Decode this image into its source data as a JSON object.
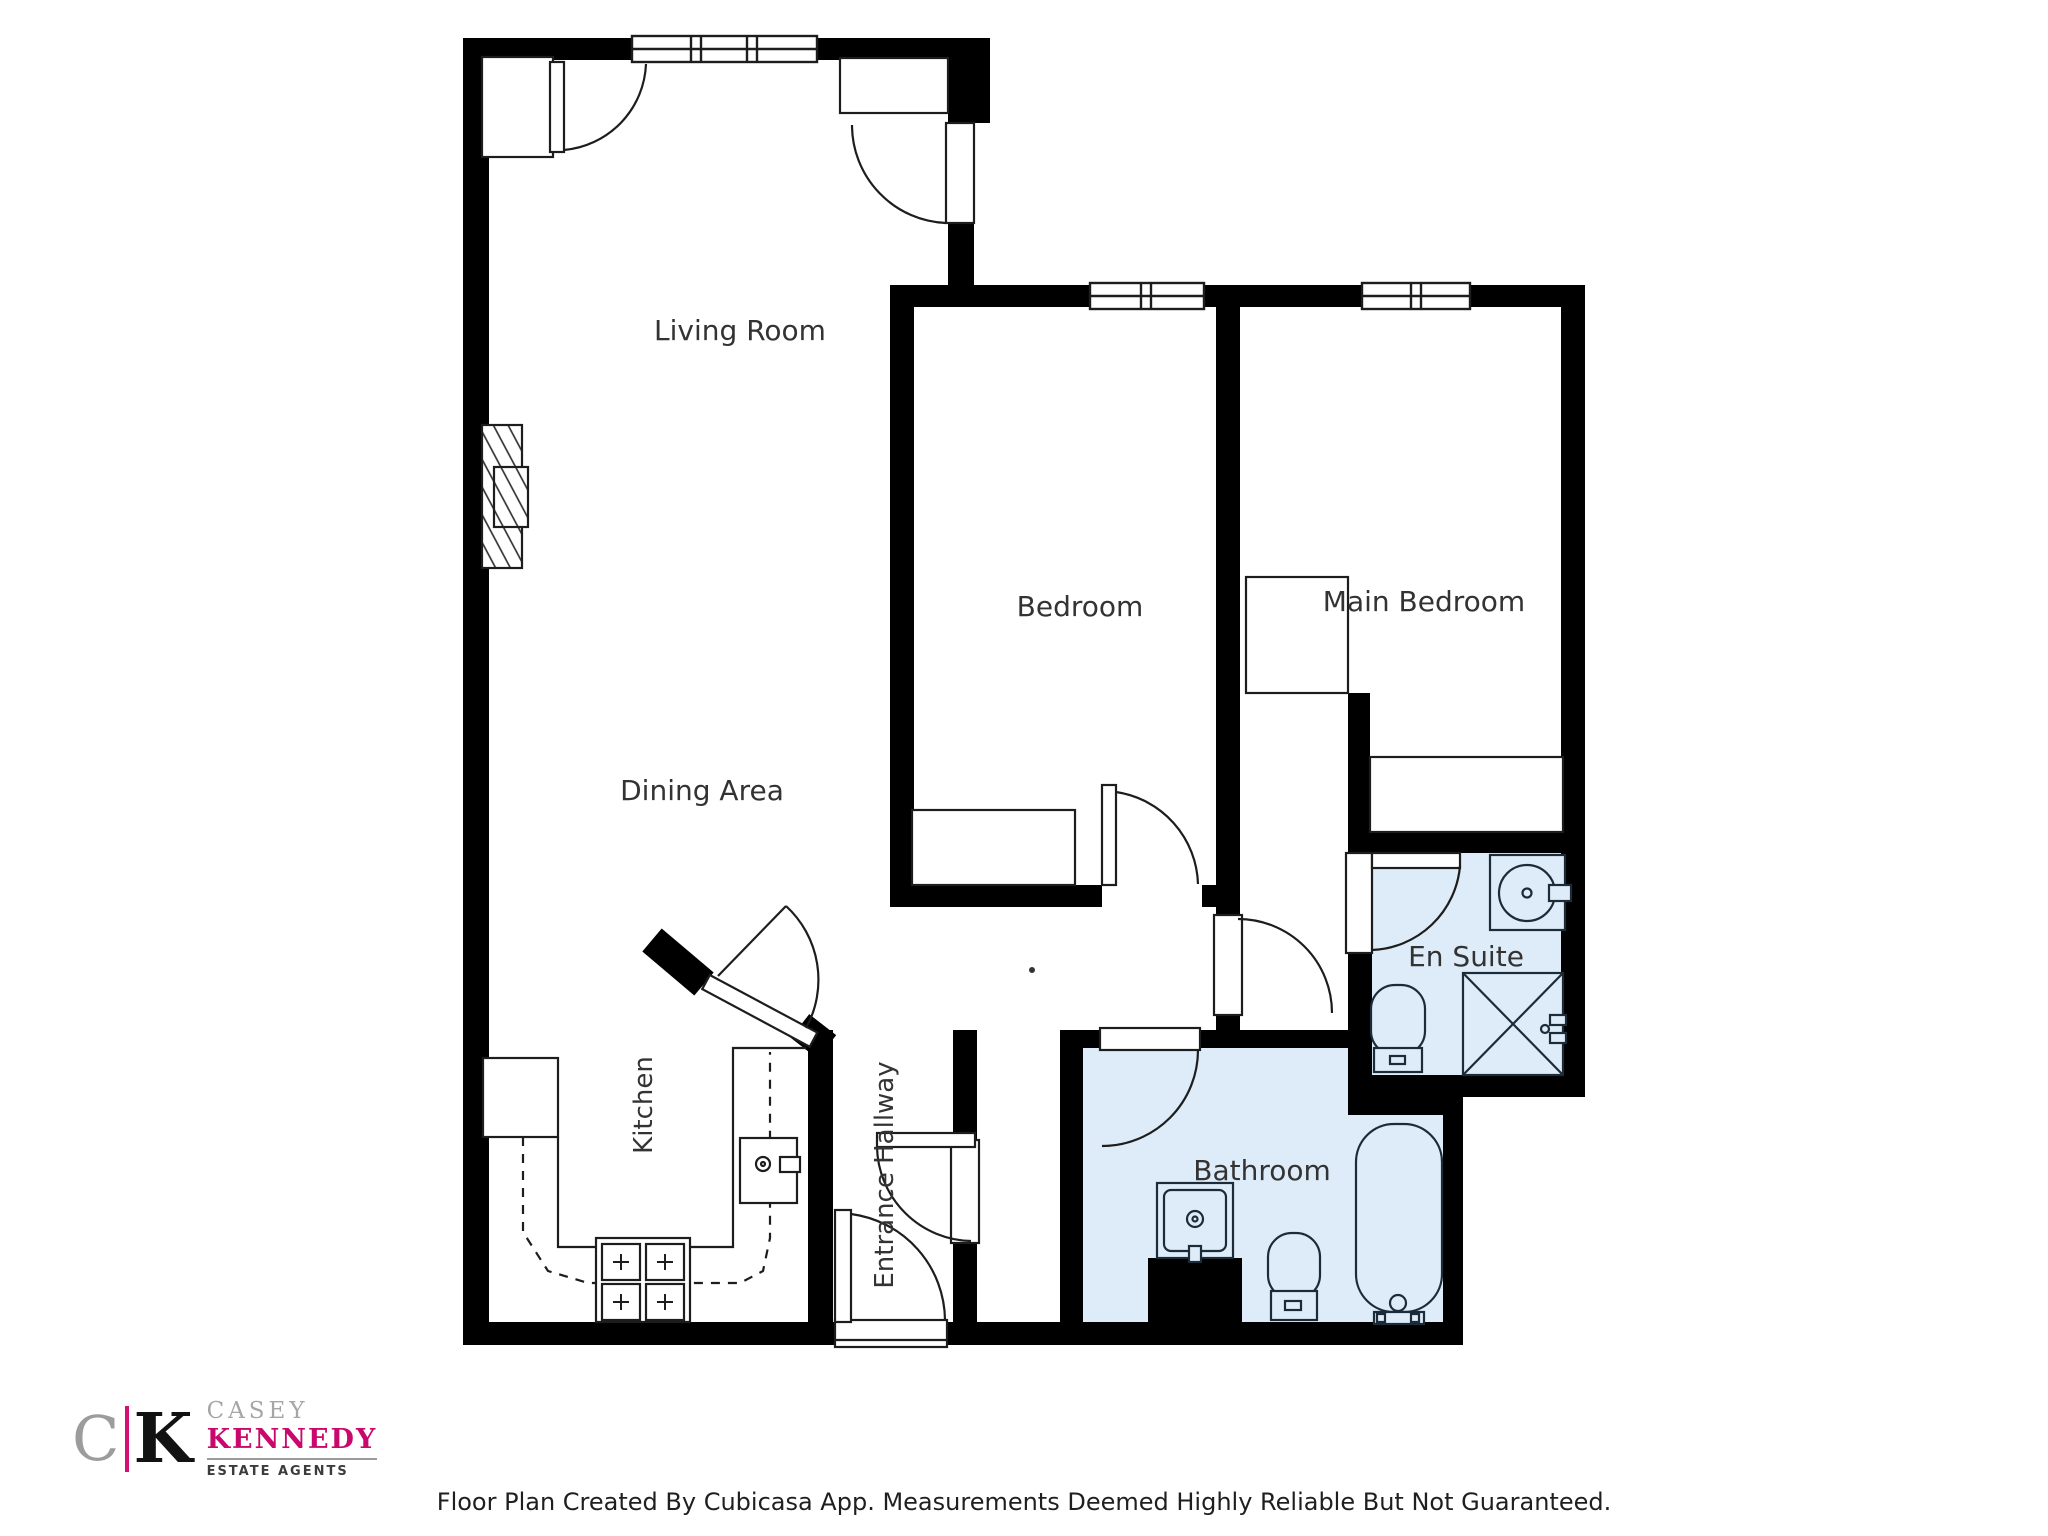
{
  "rooms": {
    "living_room": "Living Room",
    "dining_area": "Dining Area",
    "kitchen": "Kitchen",
    "entrance_hallway": "Entrance Hallway",
    "bedroom": "Bedroom",
    "main_bedroom": "Main Bedroom",
    "bathroom": "Bathroom",
    "en_suite": "En Suite"
  },
  "footer": {
    "disclaimer": "Floor Plan Created By Cubicasa App. Measurements Deemed Highly Reliable But Not Guaranteed."
  },
  "logo": {
    "letter_c": "C",
    "letter_k": "K",
    "name_top": "CASEY",
    "name_bottom": "KENNEDY",
    "tagline": "ESTATE AGENTS"
  },
  "colors": {
    "wall": "#000000",
    "wet_room_floor": "#ddecf8",
    "fixture_outline": "#1d1d1d",
    "label_text": "#333333",
    "brand_magenta": "#d60f77",
    "brand_gray": "#9c9c9c"
  }
}
